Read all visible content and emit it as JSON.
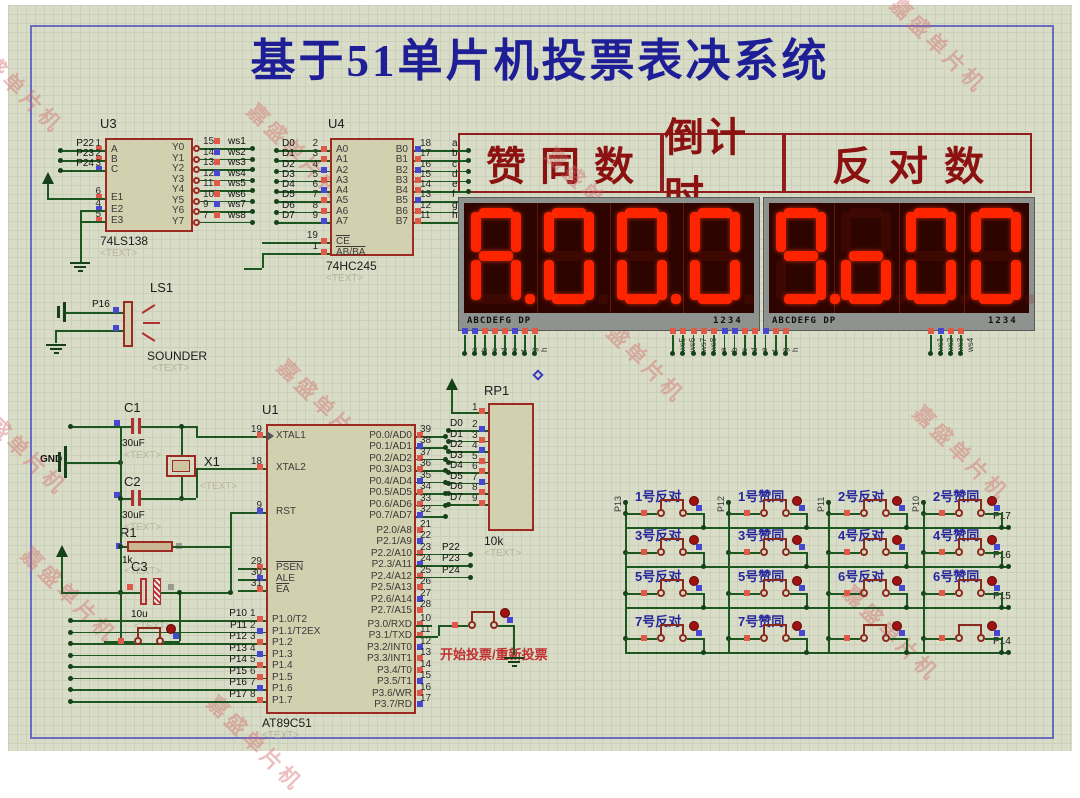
{
  "title": "基于51单片机投票表决系统",
  "watermark_text": "嘉盛单片机",
  "colors": {
    "wire": "#1c5720",
    "chip_border": "#9c2a21",
    "chip_fill": "#d3d0af",
    "title_blue": "#1e1e96",
    "header_red": "#8c1212",
    "segment_lit": "#ff2400",
    "display_bg": "#2e0400",
    "keypad_label_blue": "#26269c"
  },
  "header_labels": [
    "赞同数",
    "倒计时",
    "反对数"
  ],
  "displays": [
    {
      "digits": [
        {
          "ch": "A",
          "dp": true
        },
        {
          "ch": "0",
          "dp": false
        },
        {
          "ch": "0",
          "dp": true
        },
        {
          "ch": "0",
          "dp": false
        }
      ],
      "legend_left": "ABCDEFG DP",
      "legend_right": "1234"
    },
    {
      "digits": [
        {
          "ch": "9",
          "dp": true
        },
        {
          "ch": "o",
          "dp": false
        },
        {
          "ch": "0",
          "dp": false
        },
        {
          "ch": "0",
          "dp": false
        }
      ],
      "legend_left": "ABCDEFG DP",
      "legend_right": "1234"
    }
  ],
  "display_pins": {
    "left": [
      "a",
      "b",
      "c",
      "d",
      "e",
      "f",
      "g",
      "h"
    ],
    "middle": [
      "ws5",
      "ws6",
      "ws7",
      "ws8",
      "a",
      "b",
      "c",
      "d",
      "e",
      "f",
      "g",
      "h"
    ],
    "right": [
      "ws1",
      "ws2",
      "ws3",
      "ws4"
    ]
  },
  "u3": {
    "ref": "U3",
    "part": "74LS138",
    "placeholder": "<TEXT>",
    "left_pins": [
      {
        "name": "A",
        "num": "1",
        "label": "P22"
      },
      {
        "name": "B",
        "num": "2",
        "label": "P23"
      },
      {
        "name": "C",
        "num": "3",
        "label": "P24"
      },
      {
        "name": "E1",
        "num": "6",
        "label": ""
      },
      {
        "name": "E2",
        "num": "4",
        "label": ""
      },
      {
        "name": "E3",
        "num": "5",
        "label": ""
      }
    ],
    "right_pins": [
      {
        "name": "Y0",
        "num": "15",
        "label": "ws1"
      },
      {
        "name": "Y1",
        "num": "14",
        "label": "ws2"
      },
      {
        "name": "Y2",
        "num": "13",
        "label": "ws3"
      },
      {
        "name": "Y3",
        "num": "12",
        "label": "ws4"
      },
      {
        "name": "Y4",
        "num": "11",
        "label": "ws5"
      },
      {
        "name": "Y5",
        "num": "10",
        "label": "ws6"
      },
      {
        "name": "Y6",
        "num": "9",
        "label": "ws7"
      },
      {
        "name": "Y7",
        "num": "7",
        "label": "ws8"
      }
    ]
  },
  "u4": {
    "ref": "U4",
    "part": "74HC245",
    "placeholder": "<TEXT>",
    "left_pins": [
      {
        "name": "A0",
        "num": "2",
        "label": "D0"
      },
      {
        "name": "A1",
        "num": "3",
        "label": "D1"
      },
      {
        "name": "A2",
        "num": "4",
        "label": "D2"
      },
      {
        "name": "A3",
        "num": "5",
        "label": "D3"
      },
      {
        "name": "A4",
        "num": "6",
        "label": "D4"
      },
      {
        "name": "A5",
        "num": "7",
        "label": "D5"
      },
      {
        "name": "A6",
        "num": "8",
        "label": "D6"
      },
      {
        "name": "A7",
        "num": "9",
        "label": "D7"
      }
    ],
    "right_pins": [
      {
        "name": "B0",
        "num": "18",
        "label": "a"
      },
      {
        "name": "B1",
        "num": "17",
        "label": "b"
      },
      {
        "name": "B2",
        "num": "16",
        "label": "c"
      },
      {
        "name": "B3",
        "num": "15",
        "label": "d"
      },
      {
        "name": "B4",
        "num": "14",
        "label": "e"
      },
      {
        "name": "B5",
        "num": "13",
        "label": "f"
      },
      {
        "name": "B6",
        "num": "12",
        "label": "g"
      },
      {
        "name": "B7",
        "num": "11",
        "label": "h"
      }
    ],
    "bottom_pins": [
      {
        "name": "CE",
        "num": "19",
        "overline": true
      },
      {
        "name": "AB/BA",
        "num": "1",
        "overline": true
      }
    ]
  },
  "u1": {
    "ref": "U1",
    "part": "AT89C51",
    "placeholder": "<TEXT>",
    "left_top": [
      {
        "name": "XTAL1",
        "num": "19"
      },
      {
        "name": "XTAL2",
        "num": "18"
      },
      {
        "name": "RST",
        "num": "9"
      },
      {
        "name": "PSEN",
        "num": "29",
        "overline": true
      },
      {
        "name": "ALE",
        "num": "30"
      },
      {
        "name": "EA",
        "num": "31",
        "overline": true
      }
    ],
    "p1": [
      {
        "name": "P1.0/T2",
        "num": "1",
        "label": "P10"
      },
      {
        "name": "P1.1/T2EX",
        "num": "2",
        "label": "P11"
      },
      {
        "name": "P1.2",
        "num": "3",
        "label": "P12"
      },
      {
        "name": "P1.3",
        "num": "4",
        "label": "P13"
      },
      {
        "name": "P1.4",
        "num": "5",
        "label": "P14"
      },
      {
        "name": "P1.5",
        "num": "6",
        "label": "P15"
      },
      {
        "name": "P1.6",
        "num": "7",
        "label": "P16"
      },
      {
        "name": "P1.7",
        "num": "8",
        "label": "P17"
      }
    ],
    "p0": [
      {
        "name": "P0.0/AD0",
        "num": "39"
      },
      {
        "name": "P0.1/AD1",
        "num": "38"
      },
      {
        "name": "P0.2/AD2",
        "num": "37"
      },
      {
        "name": "P0.3/AD3",
        "num": "36"
      },
      {
        "name": "P0.4/AD4",
        "num": "35"
      },
      {
        "name": "P0.5/AD5",
        "num": "34"
      },
      {
        "name": "P0.6/AD6",
        "num": "33"
      },
      {
        "name": "P0.7/AD7",
        "num": "32"
      }
    ],
    "p2": [
      {
        "name": "P2.0/A8",
        "num": "21",
        "label": ""
      },
      {
        "name": "P2.1/A9",
        "num": "22",
        "label": ""
      },
      {
        "name": "P2.2/A10",
        "num": "23",
        "label": "P22"
      },
      {
        "name": "P2.3/A11",
        "num": "24",
        "label": "P23"
      },
      {
        "name": "P2.4/A12",
        "num": "25",
        "label": "P24"
      },
      {
        "name": "P2.5/A13",
        "num": "26",
        "label": ""
      },
      {
        "name": "P2.6/A14",
        "num": "27",
        "label": ""
      },
      {
        "name": "P2.7/A15",
        "num": "28",
        "label": ""
      }
    ],
    "p3": [
      {
        "name": "P3.0/RXD",
        "num": "10"
      },
      {
        "name": "P3.1/TXD",
        "num": "11"
      },
      {
        "name": "P3.2/INT0",
        "num": "12"
      },
      {
        "name": "P3.3/INT1",
        "num": "13"
      },
      {
        "name": "P3.4/T0",
        "num": "14"
      },
      {
        "name": "P3.5/T1",
        "num": "15"
      },
      {
        "name": "P3.6/WR",
        "num": "16"
      },
      {
        "name": "P3.7/RD",
        "num": "17"
      }
    ]
  },
  "rp1": {
    "ref": "RP1",
    "value": "10k",
    "placeholder": "<TEXT>",
    "pins": [
      {
        "num": "1",
        "label": ""
      },
      {
        "num": "2",
        "label": "D0"
      },
      {
        "num": "3",
        "label": "D1"
      },
      {
        "num": "4",
        "label": "D2"
      },
      {
        "num": "5",
        "label": "D3"
      },
      {
        "num": "6",
        "label": "D4"
      },
      {
        "num": "7",
        "label": "D5"
      },
      {
        "num": "8",
        "label": "D6"
      },
      {
        "num": "9",
        "label": "D7"
      }
    ]
  },
  "sounder": {
    "ref": "LS1",
    "part": "SOUNDER",
    "placeholder": "<TEXT>",
    "wire_label": "P16"
  },
  "analog": {
    "gnd_label": "GND",
    "c1": {
      "ref": "C1",
      "value": "30uF",
      "placeholder": "<TEXT>"
    },
    "c2": {
      "ref": "C2",
      "value": "30uF",
      "placeholder": "<TEXT>"
    },
    "x1": {
      "ref": "X1",
      "placeholder": "<TEXT>"
    },
    "r1": {
      "ref": "R1",
      "value": "1k",
      "placeholder": "<TEXT>"
    },
    "c3": {
      "ref": "C3",
      "value": "10u",
      "placeholder": "<TEXT>"
    }
  },
  "start_button": {
    "label": "开始投票/重新投票"
  },
  "keypad": {
    "col_labels": [
      "P13",
      "P12",
      "P11",
      "P10"
    ],
    "row_labels": [
      "P17",
      "P16",
      "P15",
      "P14"
    ],
    "rows": [
      [
        "1号反对",
        "1号赞同",
        "2号反对",
        "2号赞同"
      ],
      [
        "3号反对",
        "3号赞同",
        "4号反对",
        "4号赞同"
      ],
      [
        "5号反对",
        "5号赞同",
        "6号反对",
        "6号赞同"
      ],
      [
        "7号反对",
        "7号赞同",
        "",
        ""
      ]
    ]
  }
}
